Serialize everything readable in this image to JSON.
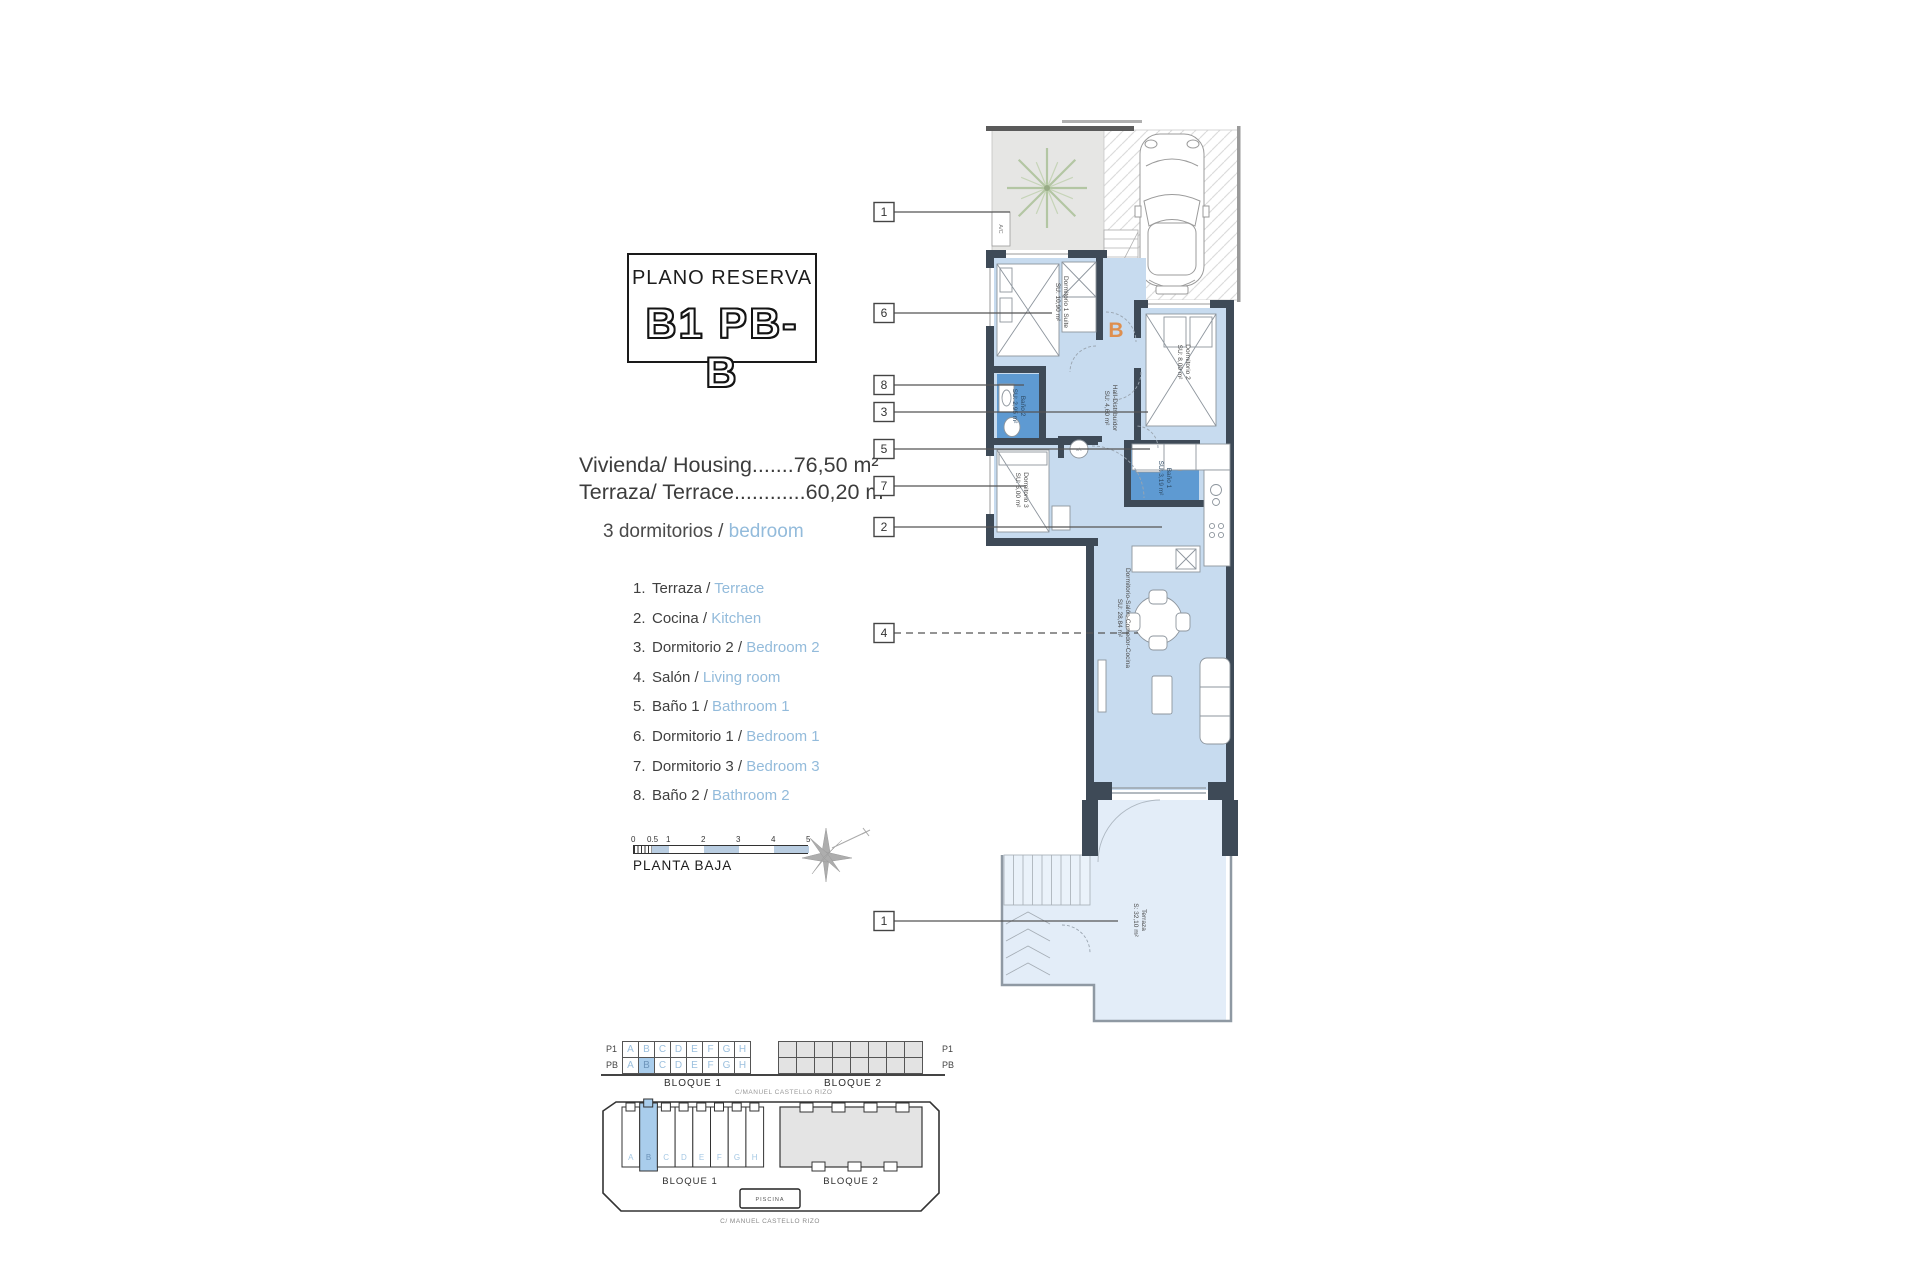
{
  "title_block": {
    "label": "PLANO RESERVA",
    "code": "B1 PB-B"
  },
  "areas": {
    "line1": "Vivienda/ Housing.......76,50 m²",
    "line2": "Terraza/ Terrace............60,20 m²"
  },
  "bedrooms": {
    "es": "3 dormitorios /",
    "en": "bedroom"
  },
  "legend": [
    {
      "num": "1.",
      "es": "Terraza /",
      "en": "Terrace"
    },
    {
      "num": "2.",
      "es": "Cocina /",
      "en": "Kitchen"
    },
    {
      "num": "3.",
      "es": "Dormitorio 2 /",
      "en": "Bedroom 2"
    },
    {
      "num": "4.",
      "es": "Salón /",
      "en": "Living room"
    },
    {
      "num": "5.",
      "es": "Baño 1 /",
      "en": "Bathroom 1"
    },
    {
      "num": "6.",
      "es": "Dormitorio 1 /",
      "en": "Bedroom 1"
    },
    {
      "num": "7.",
      "es": "Dormitorio 3 /",
      "en": "Bedroom 3"
    },
    {
      "num": "8.",
      "es": "Baño 2 /",
      "en": "Bathroom 2"
    }
  ],
  "scale_bar": {
    "ticks": [
      "0",
      "0.5",
      "1",
      "2",
      "3",
      "4",
      "5"
    ],
    "label": "PLANTA BAJA"
  },
  "floor_plan": {
    "entrance_letter": "B",
    "ac_unit": "A/C",
    "machine": "a/c",
    "rooms": {
      "dormitorio1": {
        "name": "Dormitorio 1 Suite",
        "area": "SU: 10,90 m²"
      },
      "dormitorio2": {
        "name": "Dormitorio 2",
        "area": "SU: 8,00 m²"
      },
      "dormitorio3": {
        "name": "Dormitorio 3",
        "area": "SU: 6,00 m²"
      },
      "hall": {
        "name": "Hall-Distribuidor",
        "area": "SU: 4,60 m²"
      },
      "bano1": {
        "name": "Baño 1",
        "area": "SU: 3,19 m²"
      },
      "bano2": {
        "name": "Baño 2",
        "area": "SU: 2,95 m²"
      },
      "salon": {
        "name": "Dormitorio-Salón-Comedor-Cocina",
        "area": "SU: 28,84 m²"
      },
      "terraza": {
        "name": "Terraza",
        "area": "S: 32,10 m²"
      }
    },
    "callouts": [
      "1",
      "6",
      "8",
      "3",
      "5",
      "7",
      "2",
      "4",
      "1"
    ]
  },
  "schedule": {
    "rows": [
      "P1",
      "PB"
    ],
    "bloque1": {
      "label": "BLOQUE 1",
      "letters": [
        "A",
        "B",
        "C",
        "D",
        "E",
        "F",
        "G",
        "H"
      ],
      "highlighted_row": 1,
      "highlighted_col": 1
    },
    "bloque2": {
      "label": "BLOQUE 2",
      "cols": 8
    },
    "street": "C/MANUEL CASTELLO RIZO"
  },
  "site_plan": {
    "bloque1": {
      "label": "BLOQUE 1",
      "letters": [
        "A",
        "B",
        "C",
        "D",
        "E",
        "F",
        "G",
        "H"
      ],
      "highlighted": 1
    },
    "bloque2": {
      "label": "BLOQUE 2"
    },
    "piscina": "PISCINA",
    "street": "C/ MANUEL CASTELLO RIZO"
  },
  "colors": {
    "room": "#c7dbef",
    "bath": "#5e9ad2",
    "wall": "#3e4a57",
    "terrace": "#e3edf8",
    "accent": "#93bbdb",
    "highlight": "#a9cdec",
    "entry_letter": "#de8f4f"
  }
}
